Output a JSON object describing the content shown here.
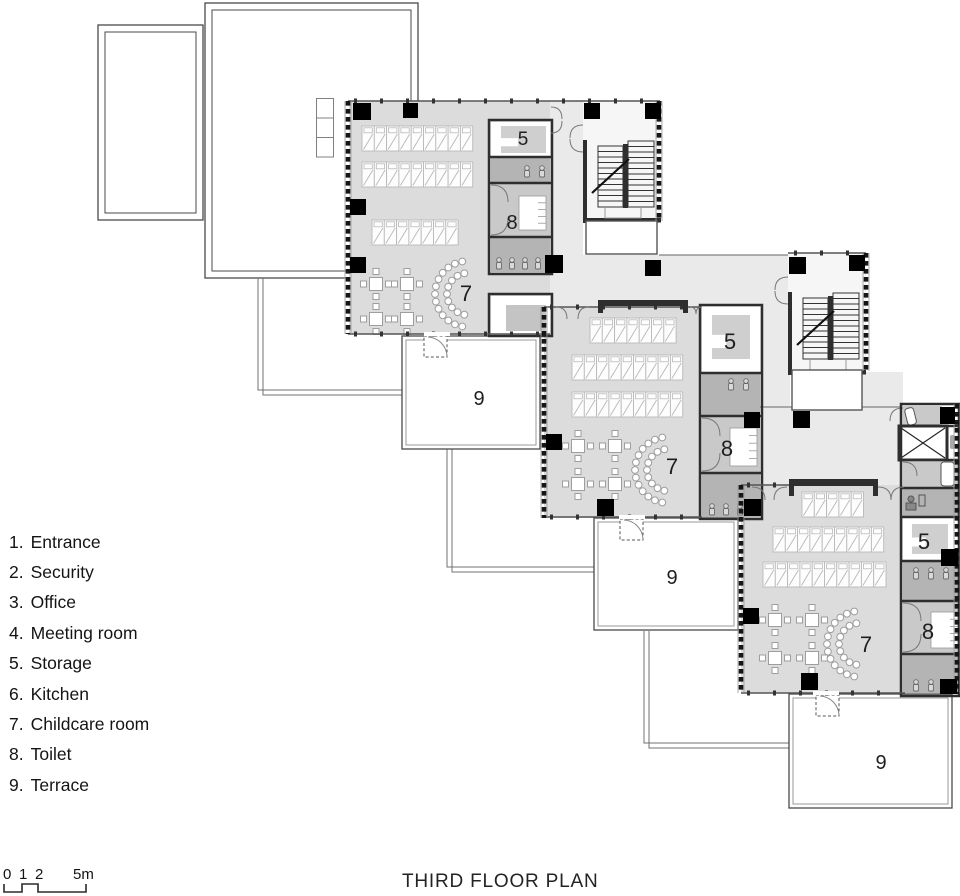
{
  "title": "THIRD FLOOR PLAN",
  "legend": {
    "items": [
      {
        "number": "1.",
        "label": "Entrance"
      },
      {
        "number": "2.",
        "label": "Security"
      },
      {
        "number": "3.",
        "label": "Office"
      },
      {
        "number": "4.",
        "label": "Meeting room"
      },
      {
        "number": "5.",
        "label": "Storage"
      },
      {
        "number": "6.",
        "label": "Kitchen"
      },
      {
        "number": "7.",
        "label": "Childcare room"
      },
      {
        "number": "8.",
        "label": "Toilet"
      },
      {
        "number": "9.",
        "label": "Terrace"
      }
    ]
  },
  "scale_bar": {
    "labels": [
      "0",
      "1",
      "2",
      "5m"
    ]
  },
  "plan": {
    "units": [
      {
        "name": "upper-wing",
        "room_labels": {
          "storage": "5",
          "toilet": "8",
          "childcare": "7",
          "terrace": "9"
        }
      },
      {
        "name": "middle-wing",
        "room_labels": {
          "storage": "5",
          "toilet": "8",
          "childcare": "7",
          "terrace": "9"
        }
      },
      {
        "name": "lower-wing",
        "room_labels": {
          "storage": "5",
          "toilet": "8",
          "childcare": "7",
          "terrace": "9"
        }
      }
    ],
    "colors": {
      "room": "#dcdcdc",
      "corridor": "#eaeaea",
      "toilet": "#b4b4b4",
      "accessible_toilet": "#c9c9c9",
      "storage_pad": "#cfcfcf",
      "wall": "#2e2e2e",
      "column": "#000000",
      "outline": "#4a4a4a",
      "furniture": "#9e9e9e",
      "hatch": "#b8b8b8"
    }
  }
}
